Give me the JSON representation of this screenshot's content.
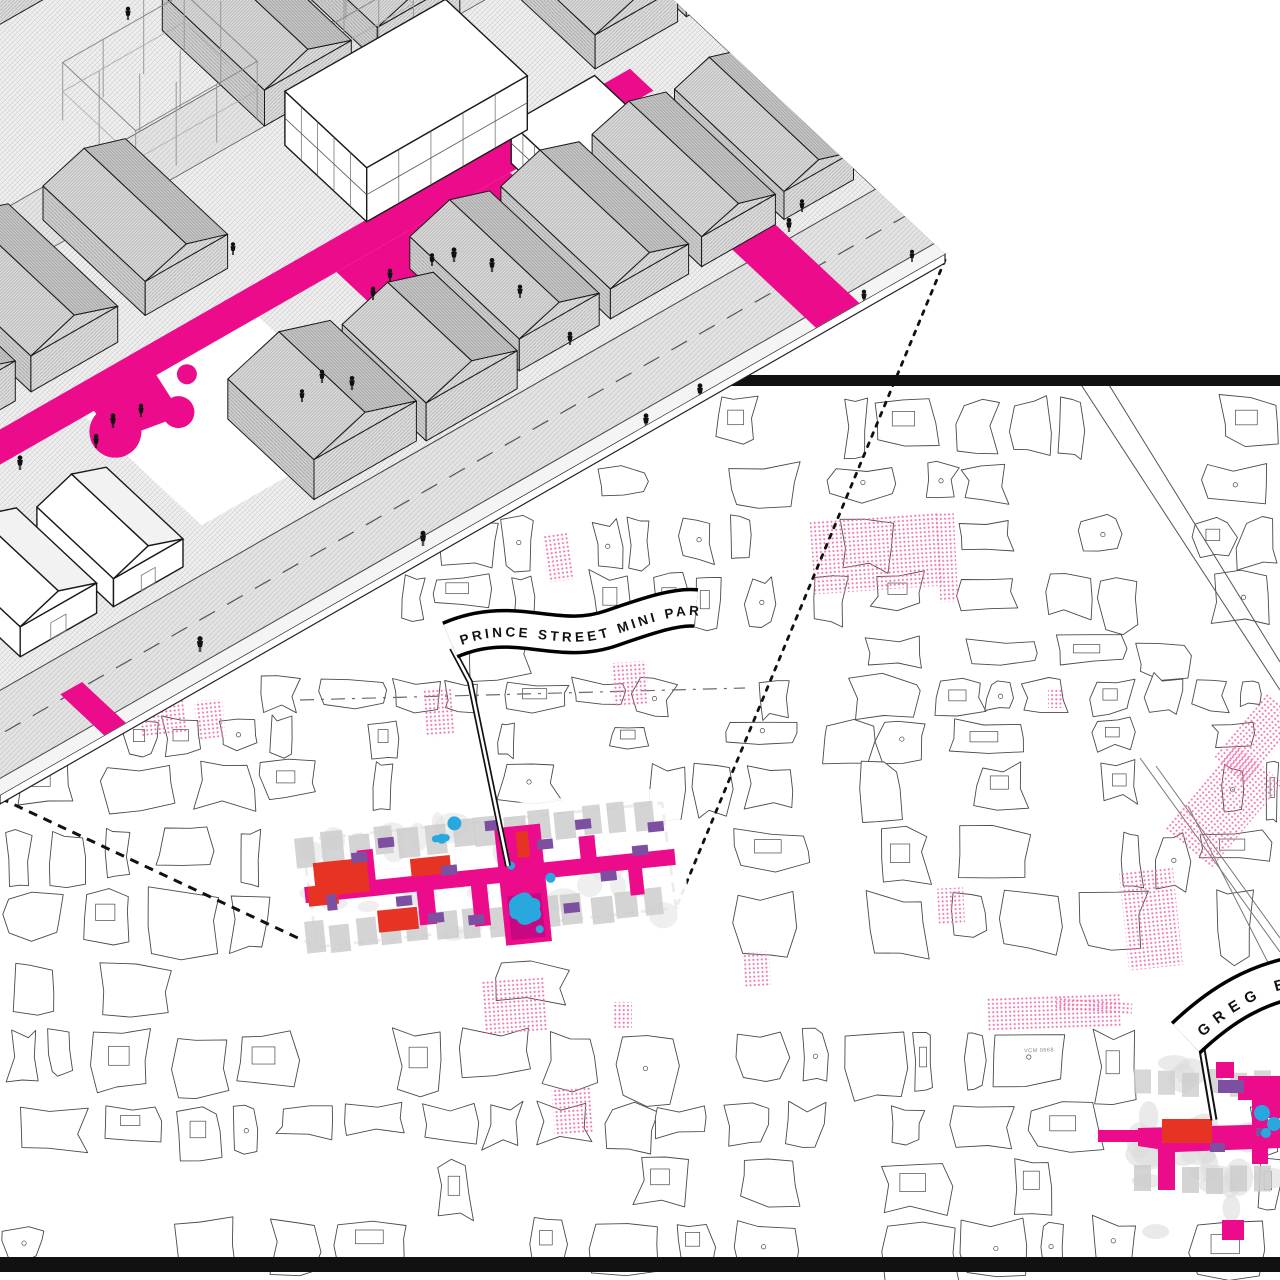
{
  "diagram": {
    "kind": "urban-design-axonometric-with-map-callout",
    "banners": {
      "prince": {
        "label": "PRINCE STREET MINI PARK"
      },
      "greg": {
        "label": "GREG BRO"
      }
    },
    "map": {
      "micro_label": "VCM 0668"
    }
  },
  "palette": {
    "magenta": "#EC0C8B",
    "dark_magenta": "#C10880",
    "red": "#E63323",
    "purple": "#7D4FA0",
    "cyan": "#29A8E0",
    "pink_dots": "#F272AE",
    "map_line": "#4A4A4A",
    "frame_black": "#111111",
    "plan_grey": "#CDCDCD",
    "axon_stroke": "#1A1A1A"
  }
}
